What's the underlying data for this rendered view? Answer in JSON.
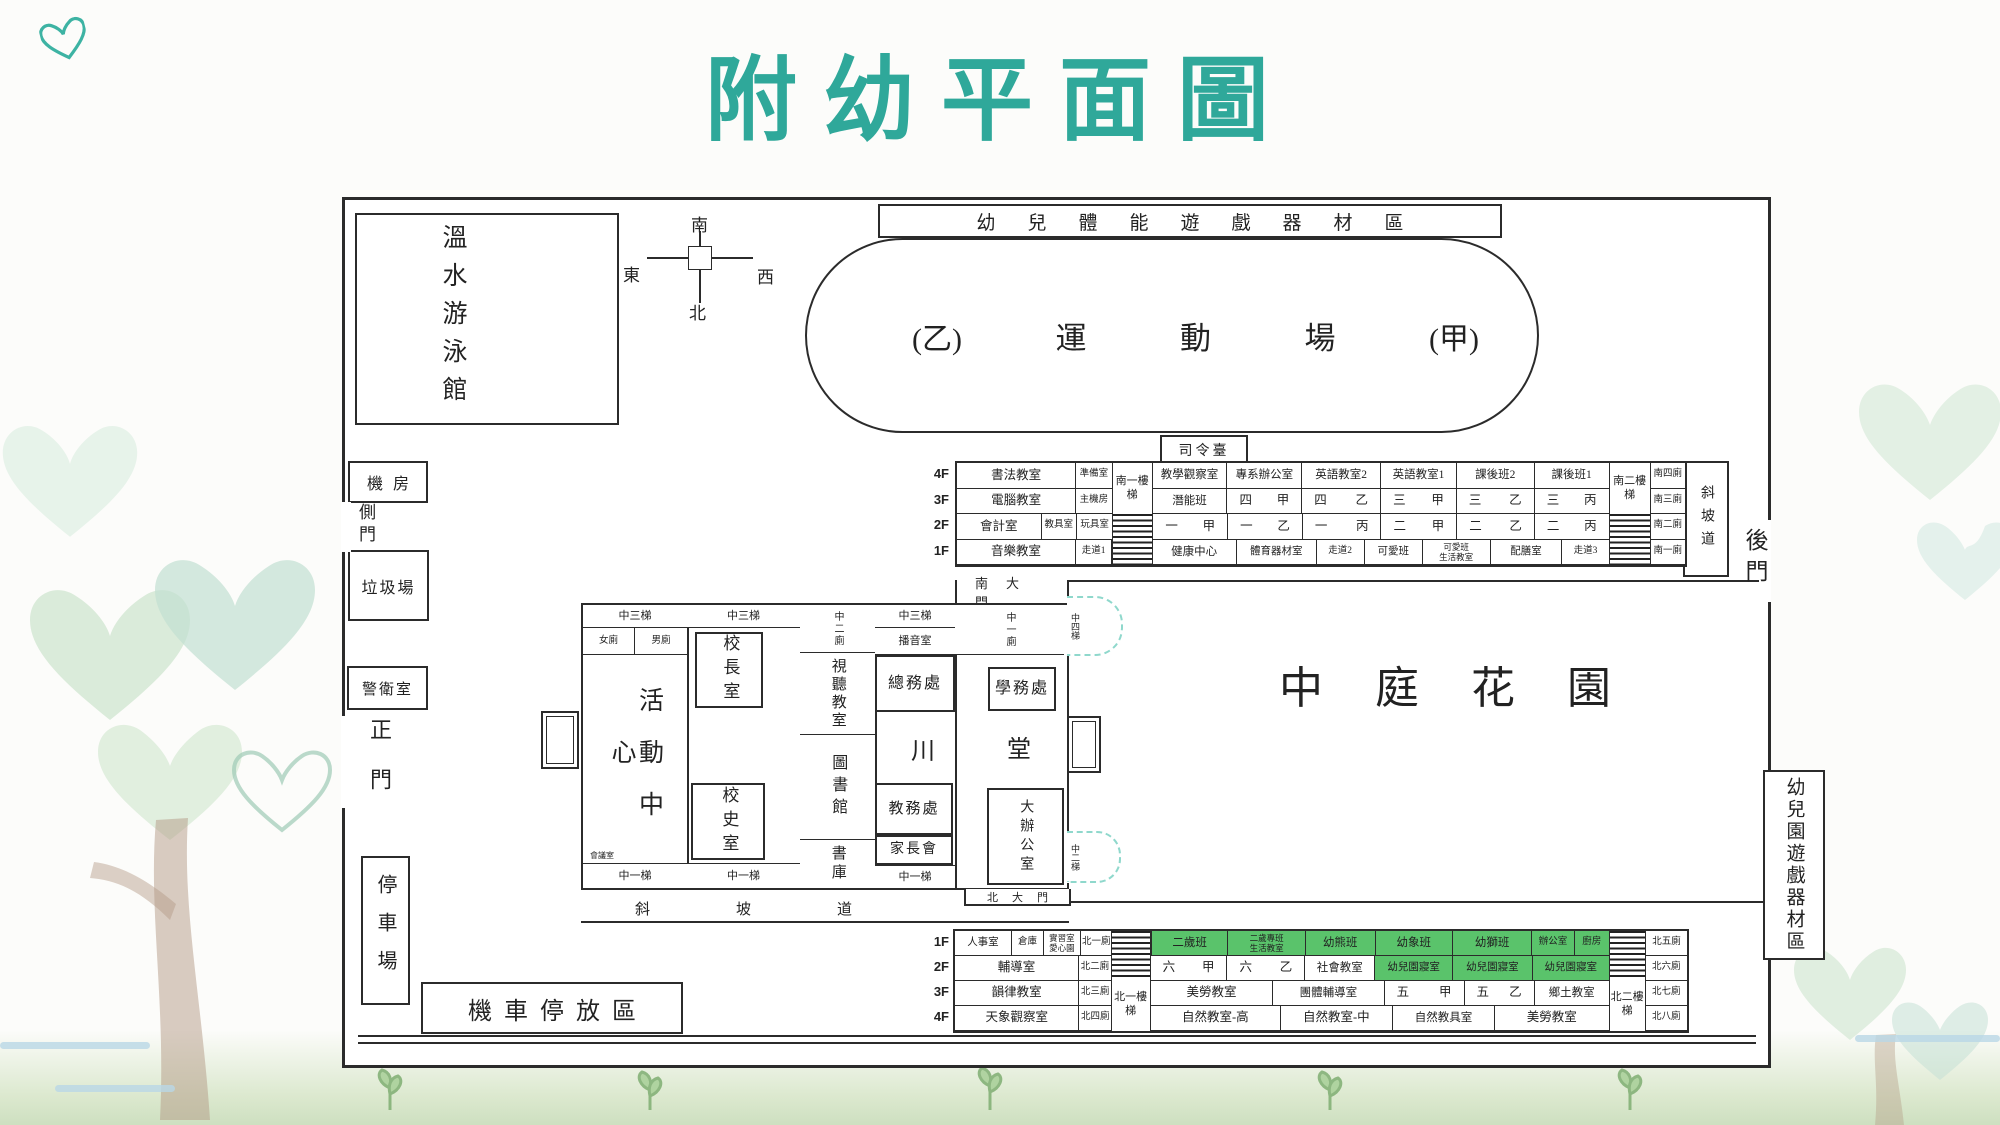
{
  "title": "附幼平面圖",
  "colors": {
    "accent": "#2fa89a",
    "room_green": "#5ac36b",
    "stair_teal": "#8fd8cc",
    "ink": "#2b2b2b"
  },
  "compass": {
    "top": "南",
    "left": "東",
    "right": "西",
    "bottom": "北"
  },
  "grounds": {
    "equip_top": "幼兒體能遊戲器材區",
    "pool": "溫水游泳館",
    "track": [
      "(乙)",
      "運",
      "動",
      "場",
      "(甲)"
    ],
    "podium": "司令臺",
    "ramp_ne": "斜坡道",
    "back_gate": "後門",
    "equip_right": "幼兒園遊戲器材區",
    "machine_room": "機房",
    "side_gate": "側門",
    "garbage_yard": "垃圾場",
    "guard_room": "警衛室",
    "main_gate": "正門",
    "car_park": "停車場",
    "scooter_area": "機車停放區",
    "courtyard": "中庭花園"
  },
  "north_bldg": {
    "floors": [
      "4F",
      "3F",
      "2F",
      "1F"
    ],
    "stair_a": "南一樓梯",
    "stair_b": "南二樓梯",
    "rows": [
      {
        "cells": [
          "書法教室",
          "準備室",
          "教學觀察室",
          "專系辦公室",
          "英語教室2",
          "英語教室1",
          "課後班2",
          "課後班1",
          "南四廁"
        ]
      },
      {
        "cells": [
          "電腦教室",
          "主機房",
          "潛能班",
          "四甲",
          "四乙",
          "三甲",
          "三乙",
          "三丙",
          "南三廁"
        ]
      },
      {
        "cells": [
          "會計室",
          "教具室",
          "玩具室",
          "一甲",
          "一乙",
          "一丙",
          "二甲",
          "二乙",
          "二丙",
          "南二廁"
        ]
      },
      {
        "cells": [
          "音樂教室",
          "走道1",
          "健康中心",
          "體育器材室",
          "走道2",
          "可愛班",
          {
            "l1": "可愛班",
            "l2": "生活教室"
          },
          "配膳室",
          "走道3",
          "南一廁"
        ]
      }
    ]
  },
  "center_bldg": {
    "stair_c3": "中三梯",
    "toilet_f": "女廁",
    "toilet_m": "男廁",
    "activity": "活動中心",
    "meeting": "會議室",
    "principal": "校長室",
    "history": "校史室",
    "toilet_c2": "中二廁",
    "av_room": "視聽教室",
    "library": "圖書館",
    "book_stack": "書庫",
    "broadcast": "播音室",
    "general_affairs": "總務處",
    "student_affairs": "學務處",
    "hall": [
      "川",
      "堂"
    ],
    "academic_affairs": "教務處",
    "parents_assoc": "家長會",
    "big_office": "大辦公室",
    "toilet_c1": "中一廁",
    "stair_c1": "中一梯",
    "stair_c4": "中四梯",
    "stair_c2": "中二梯",
    "south_gate": "南大門",
    "north_gate": "北大門",
    "ramp_s": "斜坡道"
  },
  "south_bldg": {
    "floors": [
      "1F",
      "2F",
      "3F",
      "4F"
    ],
    "stair_a": "北一樓梯",
    "stair_b": "北二樓梯",
    "rows": [
      {
        "cells": [
          "人事室",
          "倉庫",
          {
            "l1": "實習室",
            "l2": "愛心園"
          },
          "北一廁",
          "二歲班",
          {
            "l1": "二歲專班",
            "l2": "生活教室"
          },
          "幼熊班",
          "幼象班",
          "幼獅班",
          "辦公室",
          "廚房",
          "北五廁"
        ]
      },
      {
        "cells": [
          "輔導室",
          "北二廁",
          "六甲",
          "六乙",
          "社會教室",
          "幼兒園寢室",
          "幼兒園寢室",
          "幼兒園寢室",
          "北六廁"
        ]
      },
      {
        "cells": [
          "韻律教室",
          "北三廁",
          "美勞教室",
          "團體輔導室",
          "五甲",
          "五乙",
          "鄉土教室",
          "北七廁"
        ]
      },
      {
        "cells": [
          "天象觀察室",
          "北四廁",
          "自然教室-高",
          "自然教室-中",
          "自然教具室",
          "美勞教室",
          "北八廁"
        ]
      }
    ]
  }
}
